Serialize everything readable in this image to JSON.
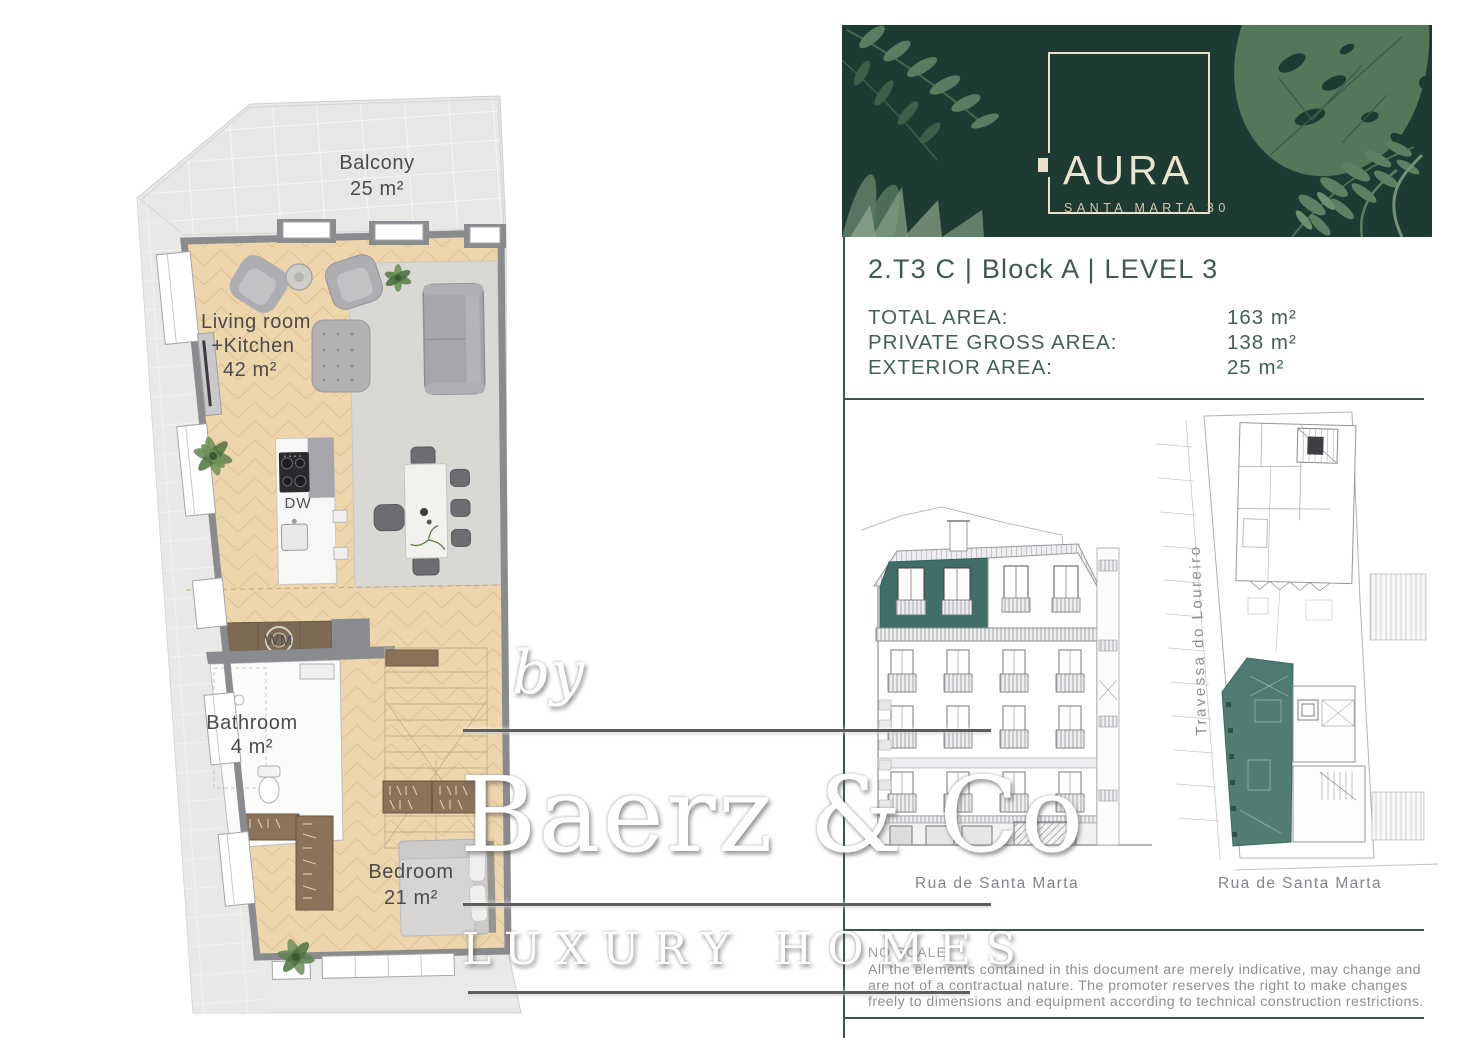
{
  "banner": {
    "logo_title": "AURA",
    "logo_subtitle": "SANTA MARTA 30"
  },
  "unit": {
    "title": "2.T3 C | Block A | LEVEL 3"
  },
  "areas": {
    "rows": [
      {
        "label": "TOTAL AREA:",
        "value": "163 m²"
      },
      {
        "label": "PRIVATE GROSS AREA:",
        "value": "138 m²"
      },
      {
        "label": "EXTERIOR AREA:",
        "value": "25 m²"
      }
    ]
  },
  "floor_plan": {
    "rooms": [
      {
        "name": "Balcony",
        "area": "25 m²"
      },
      {
        "name": "Living room",
        "name_line2": "+Kitchen",
        "area": "42 m²"
      },
      {
        "name": "Bathroom",
        "area": "4 m²"
      },
      {
        "name": "Bedroom",
        "area": "21 m²"
      }
    ],
    "appliances": {
      "dishwasher": "DW",
      "washing_machine": "WM"
    }
  },
  "drawings": {
    "elevation_caption": "Rua de Santa Marta",
    "site_plan_caption": "Rua de Santa Marta",
    "site_plan_street": "Travessa do Loureiro"
  },
  "footer": {
    "scale_note": "NO SCALE",
    "disclaimer_line1": "All the elements contained in this document are merely indicative, may change and",
    "disclaimer_line2": "are not of a contractual nature. The promoter reserves the right to make changes",
    "disclaimer_line3": "freely to dimensions and equipment according to technical construction restrictions."
  },
  "watermark": {
    "prefix": "by",
    "brand": "Baerz & Co",
    "tagline": "LUXURY HOMES"
  },
  "colors": {
    "brand_green": "#1e3b33",
    "cream": "#e9e1cc",
    "heading_teal": "#3c5a52",
    "divider": "#3a554d",
    "unit_highlight": "#4a786e",
    "floor_beige": "#eed6ac",
    "wall_gray": "#8a8b8f"
  }
}
